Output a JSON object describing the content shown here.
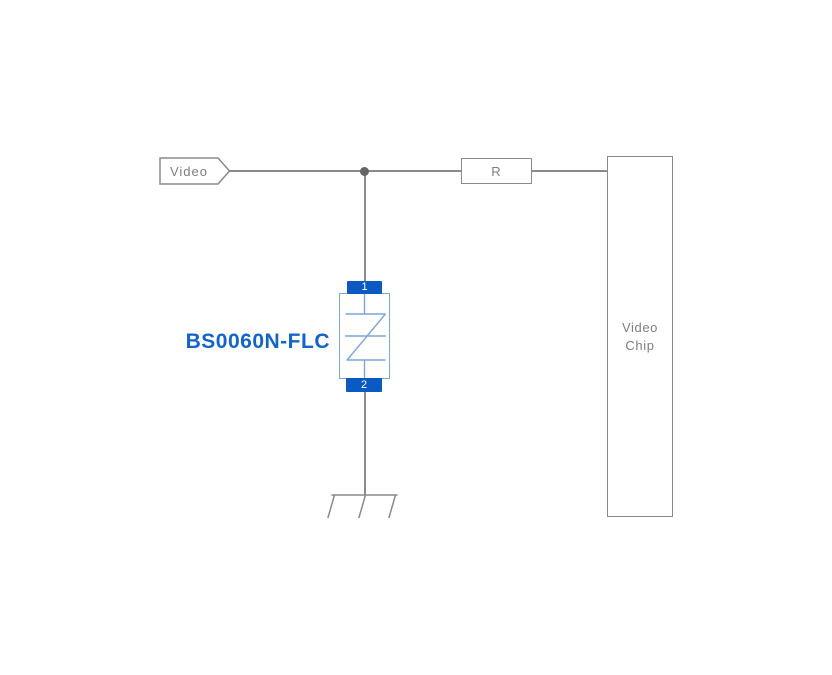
{
  "diagram_type": "circuit-schematic",
  "net_label": "Video",
  "resistor": {
    "label": "R"
  },
  "chip": {
    "label_line1": "Video",
    "label_line2": "Chip"
  },
  "tvs": {
    "part_number": "BS0060N-FLC",
    "pin_top": "1",
    "pin_bottom": "2"
  },
  "colors": {
    "background": "#ffffff",
    "wire-gray": "#8a8a8a",
    "text-gray": "#7d7d7d",
    "junction-gray": "#666666",
    "band-blue": "#0b59c3",
    "symbol-blue": "#7ba7da",
    "label-blue": "#1465c8"
  }
}
